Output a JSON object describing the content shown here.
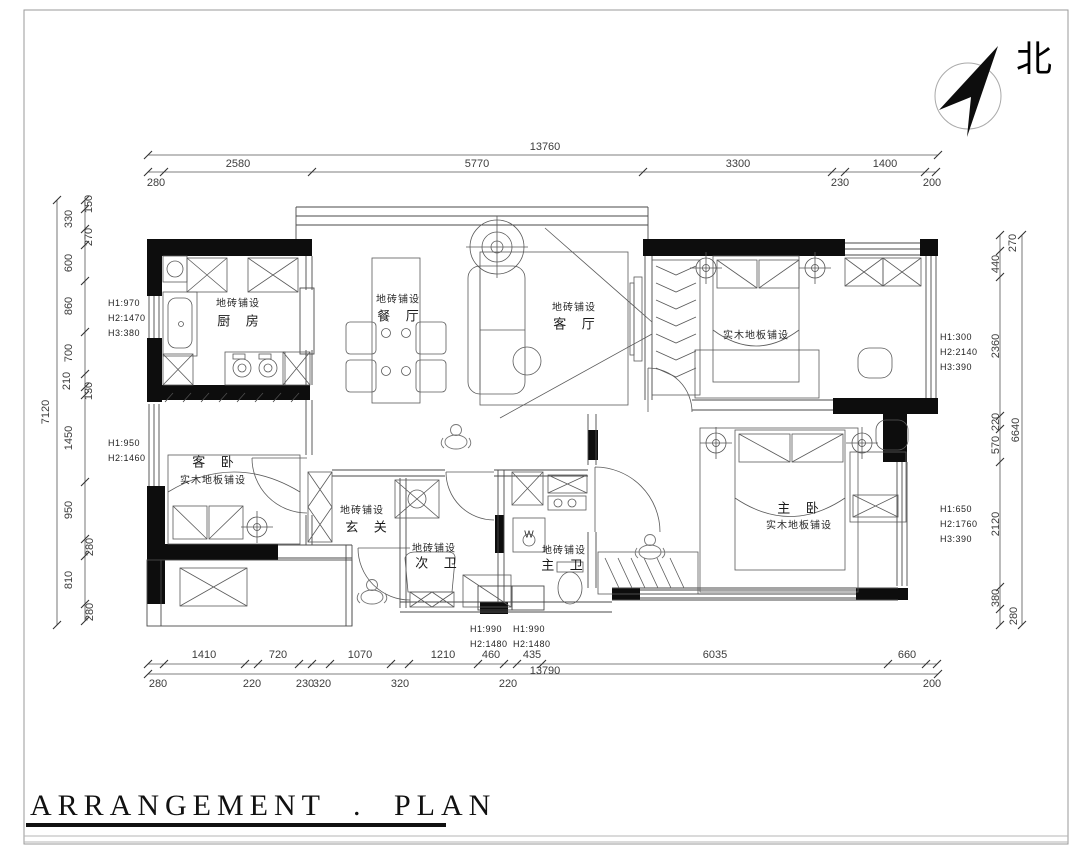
{
  "sheet": {
    "title": "ARRANGEMENT . PLAN",
    "north_label": "北"
  },
  "rooms": {
    "kitchen": {
      "floor": "地砖铺设",
      "name": "厨 房"
    },
    "dining": {
      "floor": "地砖铺设",
      "name": "餐 厅"
    },
    "living": {
      "floor": "地砖铺设",
      "name": "客 厅"
    },
    "guest_bedroom": {
      "name": "客 卧",
      "floor": "实木地板铺设"
    },
    "entry": {
      "floor": "地砖铺设",
      "name": "玄 关"
    },
    "second_bath": {
      "floor": "地砖铺设",
      "name": "次 卫"
    },
    "master_bath": {
      "floor": "地砖铺设",
      "name": "主 卫"
    },
    "master_bedroom": {
      "name": "主 卧",
      "floor": "实木地板铺设"
    },
    "bedroom2": {
      "floor": "实木地板铺设"
    }
  },
  "window_notes": {
    "kitchen": [
      "H1:970",
      "H2:1470",
      "H3:380"
    ],
    "guest_bedroom": [
      "H1:950",
      "H2:1460"
    ],
    "right_upper": [
      "H1:300",
      "H2:2140",
      "H3:390"
    ],
    "right_lower": [
      "H1:650",
      "H2:1760",
      "H3:390"
    ],
    "bath_left": [
      "H1:990",
      "H2:1480"
    ],
    "bath_right": [
      "H1:990",
      "H2:1480"
    ]
  },
  "dims": {
    "top": {
      "total": "13760",
      "segments": [
        "2580",
        "5770",
        "3300",
        "1400"
      ],
      "offsets": [
        "280",
        "230",
        "200"
      ]
    },
    "bottom": {
      "total": "13790",
      "segments": [
        "1410",
        "720",
        "1070",
        "1210",
        "460",
        "435",
        "6035",
        "660"
      ],
      "offsets": [
        "280",
        "220",
        "230",
        "320",
        "320",
        "220",
        "200"
      ]
    },
    "left": {
      "total": "7120",
      "labels": [
        "150",
        "330",
        "270",
        "600",
        "860",
        "700",
        "210",
        "130",
        "1450",
        "950",
        "280",
        "810",
        "280"
      ]
    },
    "right": {
      "total": "6640",
      "labels": [
        "270",
        "440",
        "2360",
        "220",
        "570",
        "2120",
        "380",
        "280"
      ]
    }
  },
  "appliances": {
    "washer": "W"
  }
}
